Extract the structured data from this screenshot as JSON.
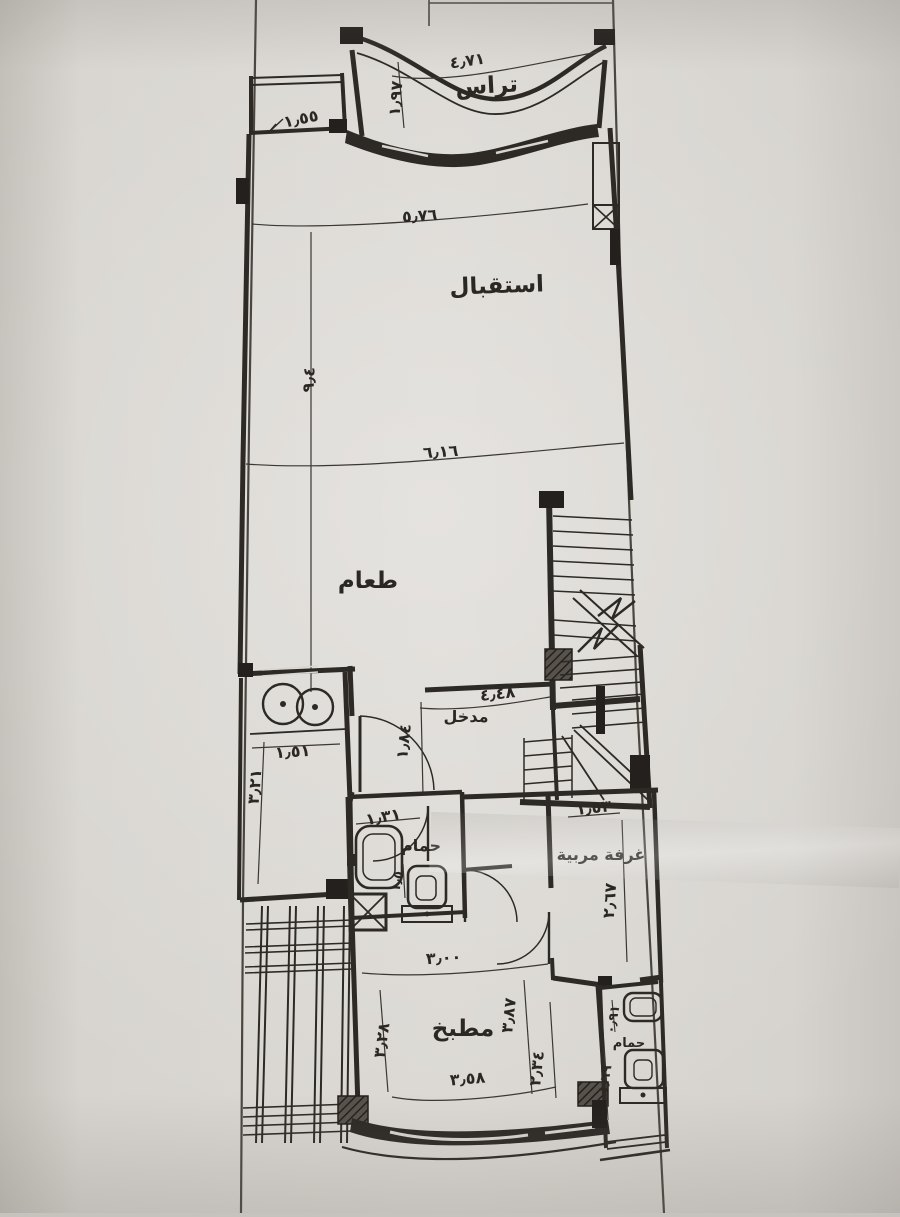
{
  "document": {
    "type": "hand-drawn architectural floor plan photo",
    "language": "Arabic"
  },
  "rooms": {
    "terrace": "تراس",
    "reception": "استقبال",
    "dining": "طعام",
    "entrance": "مدخل",
    "bathroom1": "حمام",
    "nanny_room": "غرفة مربية",
    "kitchen": "مطبخ",
    "bathroom2": "حمام"
  },
  "dims": {
    "terrace_width": "٤٫٧١",
    "terrace_depth": "١٫٩٧",
    "closet_width": "١٫٥٥",
    "reception_width": "٥٫٧٦",
    "reception_dining_depth": "٩٫٤",
    "dining_width": "٦٫١٦",
    "entrance_width": "٤٫٤٨",
    "entrance_depth": "١٫٨٤",
    "laundry_width": "١٫٥١",
    "laundry_depth": "٣٫٢١",
    "bathroom1_width": "١٫٣١",
    "bathroom1_depth": "١٫٥",
    "nanny_width": "١٫٥٣",
    "nanny_depth": "٢٫٦٧",
    "hall_width": "٣٫٠٠",
    "kitchen_left_depth": "٣٫٢٨",
    "kitchen_right_depth": "٣٫٨٧",
    "kitchen_inner_depth": "٢٫٣٤",
    "kitchen_width": "٣٫٥٨",
    "bathroom2_width": "٠٫٩١",
    "bathroom2_depth": "١٫٦٩"
  },
  "colors": {
    "paper": "#d8d5d0",
    "ink": "#2d2a25",
    "column": "#23201d"
  }
}
